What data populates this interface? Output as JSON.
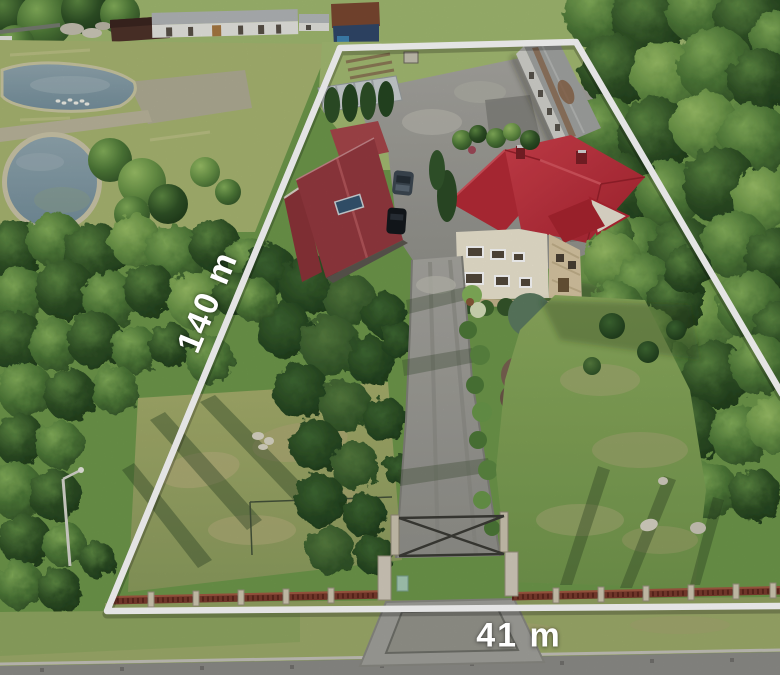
{
  "labels": {
    "depth": "140 m",
    "width": "41 m"
  },
  "colors": {
    "boundary_line": "#ffffff",
    "house_roof": "#c63541",
    "house_rear_roof": "#b82b37",
    "workshop_roof": "#963a40",
    "house_wall": "#efe8d3",
    "water": "#849ca8",
    "asphalt": "#9d9d97",
    "grass": "#7fa455",
    "fence": "#7d3c2e"
  },
  "scene": {
    "description": "Aerial drone photo of a long fenced plot with a red-roof house, maroon workshop, garage row, driveway with entrance gate, two ponds at left, forest at right; white survey lines mark the plot 140 m deep and 41 m wide."
  }
}
